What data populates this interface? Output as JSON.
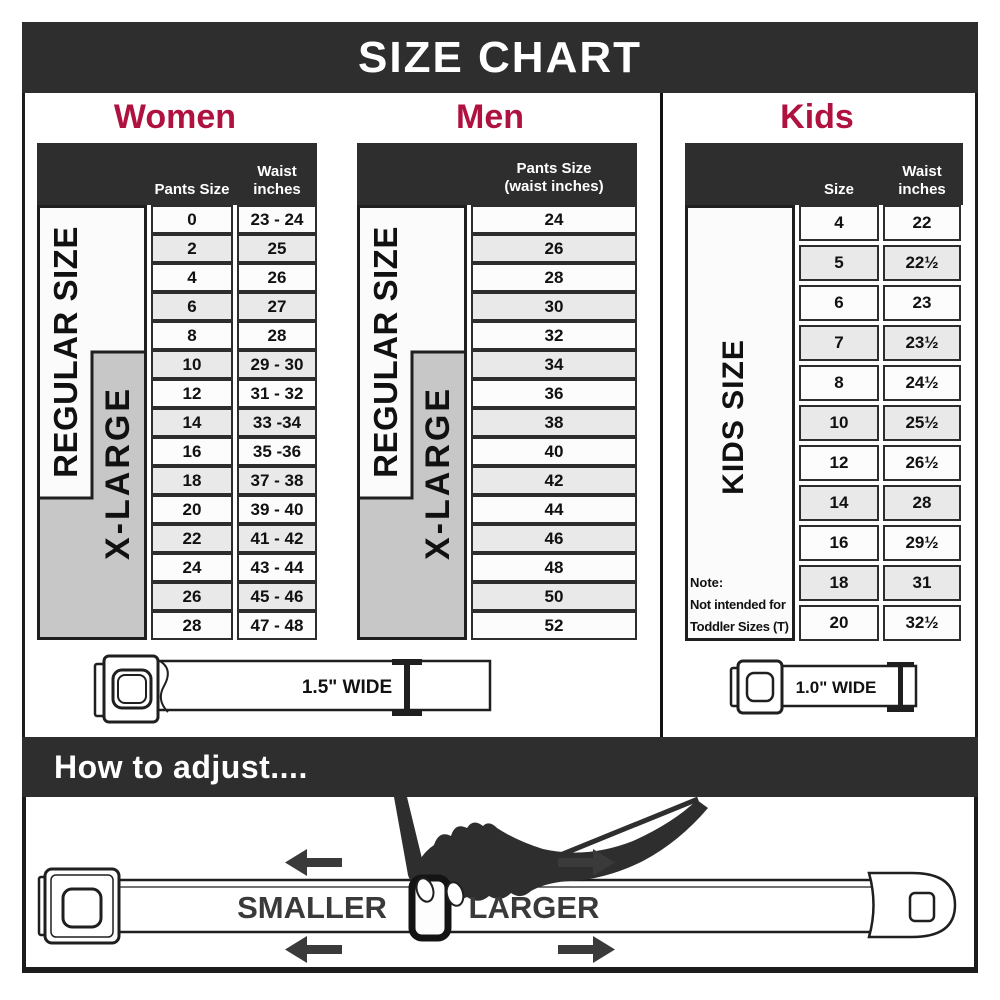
{
  "title": "SIZE CHART",
  "colors": {
    "accent": "#b01240",
    "dark_band": "#2e2e2e",
    "row_alt": "#e9e9e9",
    "xlarge_gray": "#c7c7c7"
  },
  "women": {
    "title": "Women",
    "regular_label": "REGULAR SIZE",
    "xlarge_label": "X-LARGE",
    "pants_header": "Pants Size",
    "waist_header": "Waist\ninches",
    "rows": [
      {
        "size": "0",
        "waist": "23 - 24"
      },
      {
        "size": "2",
        "waist": "25"
      },
      {
        "size": "4",
        "waist": "26"
      },
      {
        "size": "6",
        "waist": "27"
      },
      {
        "size": "8",
        "waist": "28"
      },
      {
        "size": "10",
        "waist": "29 - 30"
      },
      {
        "size": "12",
        "waist": "31 - 32"
      },
      {
        "size": "14",
        "waist": "33 -34"
      },
      {
        "size": "16",
        "waist": "35 -36"
      },
      {
        "size": "18",
        "waist": "37 - 38"
      },
      {
        "size": "20",
        "waist": "39 - 40"
      },
      {
        "size": "22",
        "waist": "41 - 42"
      },
      {
        "size": "24",
        "waist": "43 - 44"
      },
      {
        "size": "26",
        "waist": "45 - 46"
      },
      {
        "size": "28",
        "waist": "47 - 48"
      }
    ]
  },
  "men": {
    "title": "Men",
    "regular_label": "REGULAR SIZE",
    "xlarge_label": "X-LARGE",
    "header": "Pants Size\n(waist inches)",
    "rows": [
      {
        "size": "24"
      },
      {
        "size": "26"
      },
      {
        "size": "28"
      },
      {
        "size": "30"
      },
      {
        "size": "32"
      },
      {
        "size": "34"
      },
      {
        "size": "36"
      },
      {
        "size": "38"
      },
      {
        "size": "40"
      },
      {
        "size": "42"
      },
      {
        "size": "44"
      },
      {
        "size": "46"
      },
      {
        "size": "48"
      },
      {
        "size": "50"
      },
      {
        "size": "52"
      }
    ]
  },
  "kids": {
    "title": "Kids",
    "strip_label": "KIDS SIZE",
    "size_header": "Size",
    "waist_header": "Waist\ninches",
    "note_line1": "Note:",
    "note_line2": "Not intended for",
    "note_line3": "Toddler Sizes (T)",
    "rows": [
      {
        "size": "4",
        "waist": "22"
      },
      {
        "size": "5",
        "waist": "22½"
      },
      {
        "size": "6",
        "waist": "23"
      },
      {
        "size": "7",
        "waist": "23½"
      },
      {
        "size": "8",
        "waist": "24½"
      },
      {
        "size": "10",
        "waist": "25½"
      },
      {
        "size": "12",
        "waist": "26½"
      },
      {
        "size": "14",
        "waist": "28"
      },
      {
        "size": "16",
        "waist": "29½"
      },
      {
        "size": "18",
        "waist": "31"
      },
      {
        "size": "20",
        "waist": "32½"
      }
    ]
  },
  "belts": {
    "women_men_width": "1.5\" WIDE",
    "kids_width": "1.0\" WIDE"
  },
  "adjust": {
    "heading": "How to adjust....",
    "smaller_label": "SMALLER",
    "larger_label": "LARGER"
  }
}
